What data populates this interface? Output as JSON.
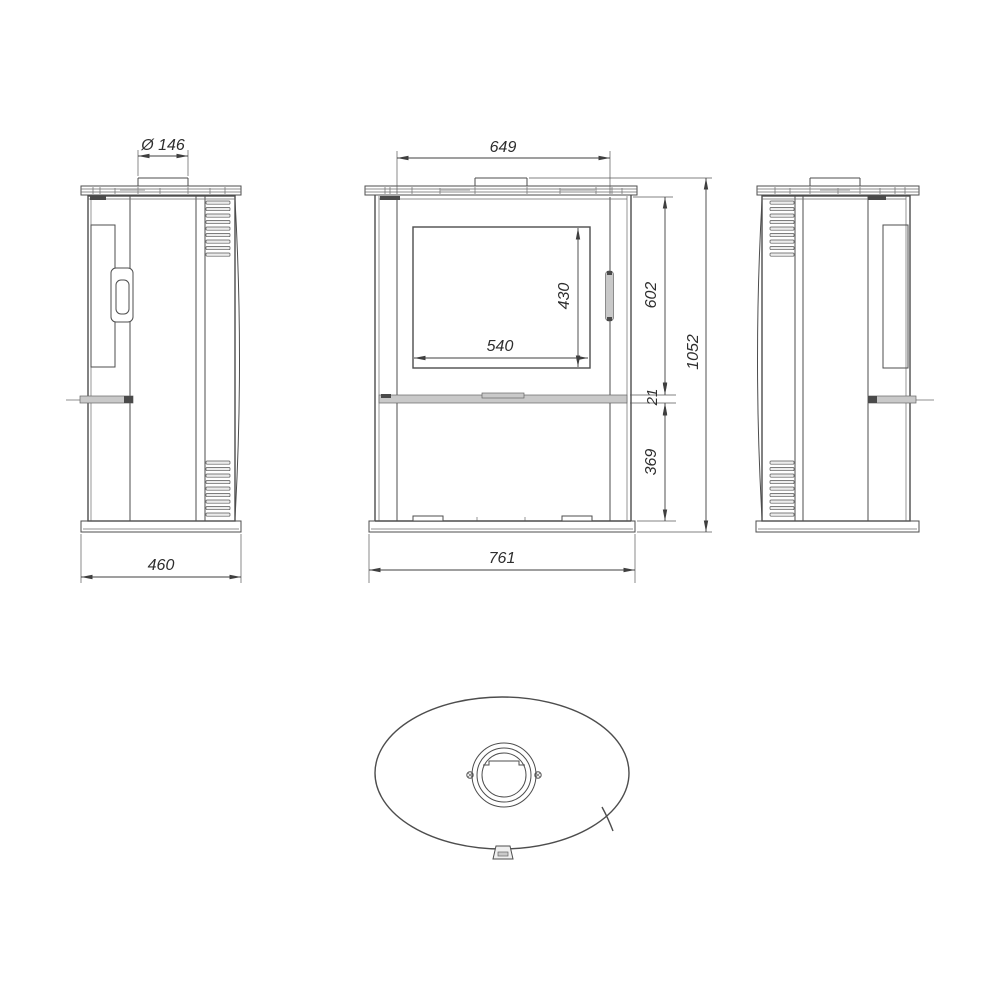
{
  "dimensions": {
    "flue_diameter": "Ø 146",
    "top_width": "649",
    "glass_width": "540",
    "glass_height": "430",
    "door_height": "602",
    "band_height": "21",
    "lower_height": "369",
    "overall_height": "1052",
    "depth": "460",
    "overall_width": "761"
  },
  "colors": {
    "background": "#ffffff",
    "line": "#4d4d4d",
    "dimension_line": "#3f3f3f",
    "text": "#2e2e2e",
    "gray_fill": "#c9c9c9",
    "dark_fill": "#4a4a4a"
  }
}
